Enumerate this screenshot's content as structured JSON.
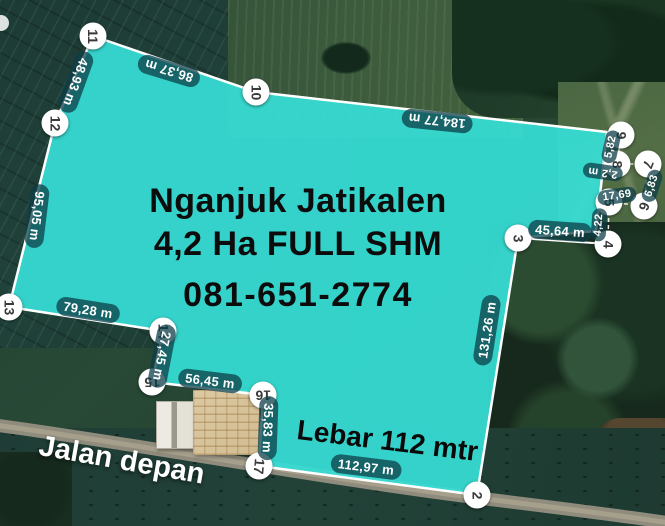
{
  "headline": {
    "line1": "Nganjuk Jatikalen",
    "line2": "4,2 Ha FULL SHM",
    "line3": "081-651-2774"
  },
  "annotations": {
    "frontage": "Lebar 112 mtr",
    "road_front": "Jalan depan"
  },
  "measurements": [
    {
      "edge": "11-12",
      "text": "48,93 m"
    },
    {
      "edge": "11-10",
      "text": "86,37 m"
    },
    {
      "edge": "10-9",
      "text": "184,77 m"
    },
    {
      "edge": "12-13",
      "text": "95,05 m"
    },
    {
      "edge": "13-14",
      "text": "79,28 m"
    },
    {
      "edge": "14-15",
      "text": "27,45 m"
    },
    {
      "edge": "15-16",
      "text": "56,45 m"
    },
    {
      "edge": "16-17",
      "text": "35,83 m"
    },
    {
      "edge": "17-2",
      "text": "112,97 m"
    },
    {
      "edge": "3-2",
      "text": "131,26 m"
    },
    {
      "edge": "4-3",
      "text": "45,64 m"
    },
    {
      "edge": "6-5",
      "text": "17,69"
    },
    {
      "edge": "5-4",
      "text": "4,22"
    },
    {
      "edge": "9-8",
      "text": "5,82"
    },
    {
      "edge": "8-7",
      "text": "2,2 m"
    },
    {
      "edge": "7-6",
      "text": "6,83"
    }
  ],
  "vertices": [
    {
      "num": "11"
    },
    {
      "num": "10"
    },
    {
      "num": "12"
    },
    {
      "num": "13"
    },
    {
      "num": "14"
    },
    {
      "num": "15"
    },
    {
      "num": "16"
    },
    {
      "num": "17"
    },
    {
      "num": "2"
    },
    {
      "num": "3"
    },
    {
      "num": "4"
    },
    {
      "num": "5"
    },
    {
      "num": "6"
    },
    {
      "num": "7"
    },
    {
      "num": "8"
    },
    {
      "num": "9"
    }
  ],
  "colors": {
    "parcel_fill": "#36ded5",
    "parcel_stroke": "#ffffff",
    "pill_bg": "#0c3d46",
    "road": "#8f8b7d"
  }
}
